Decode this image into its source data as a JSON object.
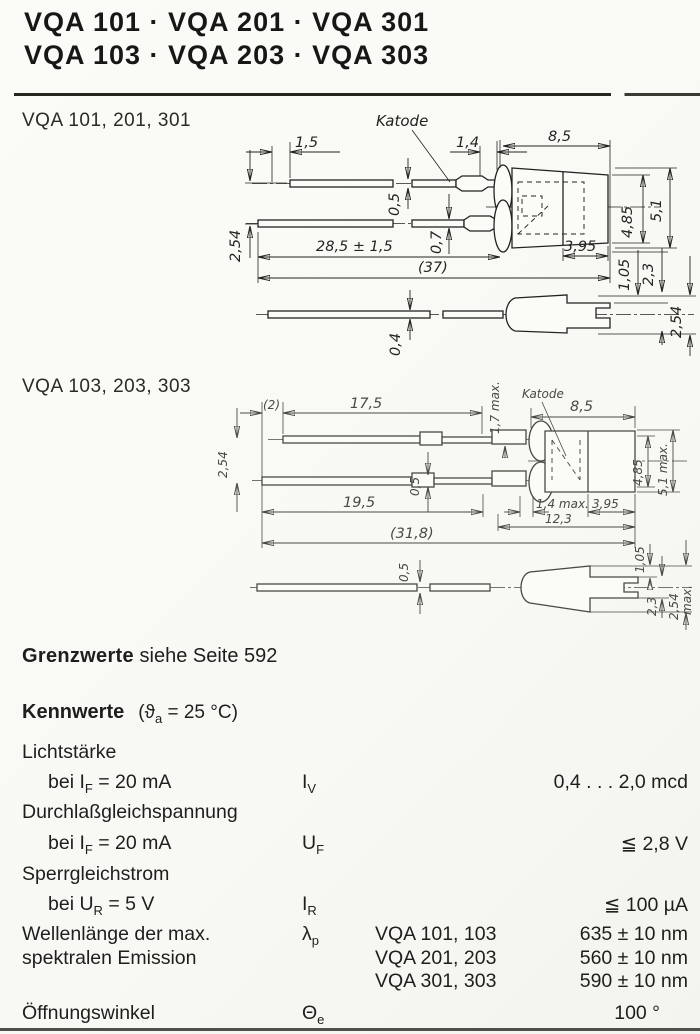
{
  "header": {
    "line1": "VQA 101 · VQA 201 · VQA 301",
    "line2": "VQA 103 · VQA 203 · VQA 303"
  },
  "drawing1": {
    "label": "VQA 101, 201, 301",
    "katode": "Katode",
    "dims": {
      "lead_offset": "1,5",
      "front_gap": "1,4",
      "body_length": "8,5",
      "dia_rear": "4,85",
      "dia_front": "5,1",
      "rear_length": "3,95",
      "pitch": "2,54",
      "lead_thickness_kathode": "0,5",
      "lead_thickness_anode": "0,7",
      "lead_length": "28,5 ± 1,5",
      "overall_length": "(37)",
      "notch_offset": "1,05",
      "notch_height": "2,3",
      "side_lead_thickness": "0,4",
      "side_height": "2,54"
    }
  },
  "drawing2": {
    "label": "VQA 103, 203, 303",
    "katode": "Katode",
    "dims": {
      "lead_offset": "(2)",
      "kathode_lead_length": "17,5",
      "crimp_length": "1,7 max.",
      "body_length": "8,5",
      "dia_rear": "4,85",
      "dia_front": "5,1 max.",
      "pitch": "2,54",
      "lead_thickness": "0,5",
      "anode_lead_length": "19,5",
      "dome_length": "1,4 max.",
      "rear_length": "3,95",
      "head_length": "12,3",
      "overall_length": "(31,8)",
      "side_lead_thickness": "0,5",
      "notch_offset": "1,05",
      "notch_height": "2,3",
      "side_height": "2,54",
      "side_height_suffix": "max."
    }
  },
  "grenzwerte": {
    "label": "Grenzwerte",
    "text": "siehe Seite 592"
  },
  "kennwerte": {
    "heading": "Kennwerte",
    "condition": {
      "pre": "(ϑ",
      "sub": "a",
      "post": " = 25 °C)"
    },
    "lichtstaerke": {
      "name": "Lichtstärke",
      "cond_pre": "bei I",
      "cond_sub": "F",
      "cond_post": " = 20 mA",
      "symbol_base": "I",
      "symbol_sub": "V",
      "value": "0,4 . . . 2,0 mcd"
    },
    "durchlassspannung": {
      "name": "Durchlaßgleichspannung",
      "cond_pre": "bei I",
      "cond_sub": "F",
      "cond_post": " = 20 mA",
      "symbol_base": "U",
      "symbol_sub": "F",
      "value": "≦ 2,8 V"
    },
    "sperrstrom": {
      "name": "Sperrgleichstrom",
      "cond_pre": "bei U",
      "cond_sub": "R",
      "cond_post": " = 5 V",
      "symbol_base": "I",
      "symbol_sub": "R",
      "value": "≦ 100 µA"
    },
    "wellenlaenge": {
      "name_line1": "Wellenlänge der max.",
      "name_line2": "spektralen Emission",
      "symbol_base": "λ",
      "symbol_sub": "p",
      "variants": [
        {
          "types": "VQA 101, 103",
          "value": "635 ± 10 nm"
        },
        {
          "types": "VQA 201, 203",
          "value": "560 ± 10 nm"
        },
        {
          "types": "VQA 301, 303",
          "value": "590 ± 10 nm"
        }
      ]
    },
    "oeffnungswinkel": {
      "name": "Öffnungswinkel",
      "symbol_base": "Θ",
      "symbol_sub": "e",
      "value": "100 °"
    }
  }
}
